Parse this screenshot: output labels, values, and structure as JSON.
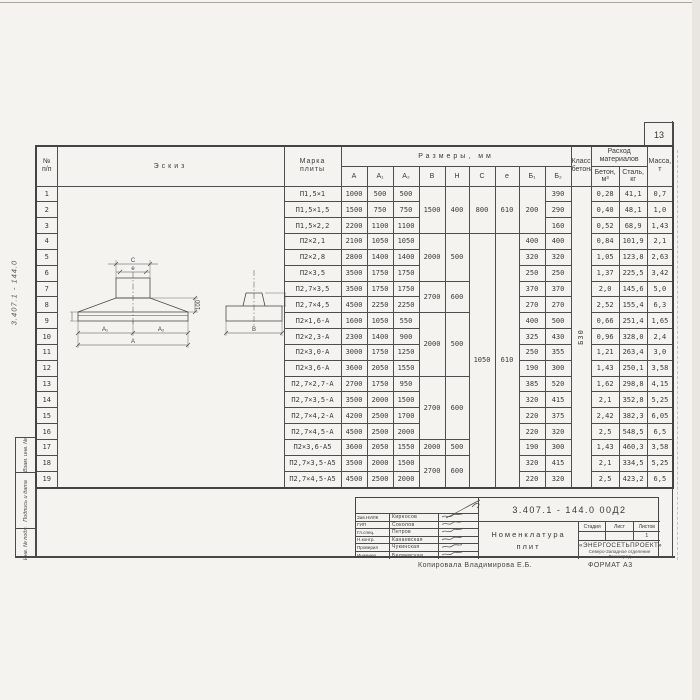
{
  "margins": {
    "page_number": "13",
    "side_ref": "3.407.1 - 144.0",
    "stamp_boxes": [
      "Взам. инв. №",
      "Подпись и дата",
      "Инв. № подл."
    ]
  },
  "table": {
    "header": {
      "num_top": "№",
      "num_bot": "п/п",
      "sketch": "Эскиз",
      "mark_top": "Марка",
      "mark_bot": "плиты",
      "dims": "Размеры, мм",
      "dim_cols": [
        "A",
        "A₁",
        "A₂",
        "B",
        "H",
        "C",
        "e",
        "Б₁",
        "Б₂"
      ],
      "class_top": "Класс",
      "class_bot": "бетона",
      "cons_top": "Расход",
      "cons_bot": "материалов",
      "cons_cols": [
        "Бетон, м³",
        "Сталь, кг"
      ],
      "mass_top": "Масса,",
      "mass_bot": "т"
    },
    "concrete_class": "Б30",
    "rows": [
      [
        "1",
        {
          "v": "",
          "rs": 19,
          "cls": "sk"
        },
        {
          "v": "П1,5×1",
          "cls": "mark"
        },
        "1000",
        "500",
        "500",
        {
          "v": "1500",
          "rs": 3
        },
        {
          "v": "400",
          "rs": 3
        },
        {
          "v": "800",
          "rs": 3
        },
        {
          "v": "610",
          "rs": 3
        },
        {
          "v": "200",
          "rs": 3
        },
        "390",
        {
          "v": "Б30",
          "rs": 19,
          "cls": "rot"
        },
        "0,28",
        "41,1",
        "0,7"
      ],
      [
        "2",
        {
          "v": "П1,5×1,5",
          "cls": "mark"
        },
        "1500",
        "750",
        "750",
        "290",
        "0,40",
        "48,1",
        "1,0"
      ],
      [
        "3",
        {
          "v": "П1,5×2,2",
          "cls": "mark"
        },
        "2200",
        "1100",
        "1100",
        "160",
        "0,52",
        "68,9",
        "1,43"
      ],
      [
        "4",
        {
          "v": "П2×2,1",
          "cls": "mark"
        },
        "2100",
        "1050",
        "1050",
        {
          "v": "2000",
          "rs": 3
        },
        {
          "v": "500",
          "rs": 3
        },
        {
          "v": "1050",
          "rs": 16
        },
        {
          "v": "610",
          "rs": 16
        },
        "400",
        "400",
        "0,84",
        "101,9",
        "2,1"
      ],
      [
        "5",
        {
          "v": "П2×2,8",
          "cls": "mark"
        },
        "2800",
        "1400",
        "1400",
        "320",
        "320",
        "1,05",
        "123,8",
        "2,63"
      ],
      [
        "6",
        {
          "v": "П2×3,5",
          "cls": "mark"
        },
        "3500",
        "1750",
        "1750",
        "250",
        "250",
        "1,37",
        "225,5",
        "3,42"
      ],
      [
        "7",
        {
          "v": "П2,7×3,5",
          "cls": "mark"
        },
        "3500",
        "1750",
        "1750",
        {
          "v": "2700",
          "rs": 2
        },
        {
          "v": "600",
          "rs": 2
        },
        "370",
        "370",
        "2,0",
        "145,6",
        "5,0"
      ],
      [
        "8",
        {
          "v": "П2,7×4,5",
          "cls": "mark"
        },
        "4500",
        "2250",
        "2250",
        "270",
        "270",
        "2,52",
        "155,4",
        "6,3"
      ],
      [
        "9",
        {
          "v": "П2×1,6-А",
          "cls": "mark"
        },
        "1600",
        "1050",
        "550",
        {
          "v": "2000",
          "rs": 4
        },
        {
          "v": "500",
          "rs": 4
        },
        "400",
        "500",
        "0,66",
        "251,4",
        "1,65"
      ],
      [
        "10",
        {
          "v": "П2×2,3-А",
          "cls": "mark"
        },
        "2300",
        "1400",
        "900",
        "325",
        "430",
        "0,96",
        "328,0",
        "2,4"
      ],
      [
        "11",
        {
          "v": "П2×3,0-А",
          "cls": "mark"
        },
        "3000",
        "1750",
        "1250",
        "250",
        "355",
        "1,21",
        "263,4",
        "3,0"
      ],
      [
        "12",
        {
          "v": "П2×3,6-А",
          "cls": "mark"
        },
        "3600",
        "2050",
        "1550",
        "190",
        "300",
        "1,43",
        "250,1",
        "3,58"
      ],
      [
        "13",
        {
          "v": "П2,7×2,7-А",
          "cls": "mark"
        },
        "2700",
        "1750",
        "950",
        {
          "v": "2700",
          "rs": 4
        },
        {
          "v": "600",
          "rs": 4
        },
        "385",
        "520",
        "1,62",
        "298,8",
        "4,15"
      ],
      [
        "14",
        {
          "v": "П2,7×3,5-А",
          "cls": "mark"
        },
        "3500",
        "2000",
        "1500",
        "320",
        "415",
        "2,1",
        "352,8",
        "5,25"
      ],
      [
        "15",
        {
          "v": "П2,7×4,2-А",
          "cls": "mark"
        },
        "4200",
        "2500",
        "1700",
        "220",
        "375",
        "2,42",
        "382,3",
        "6,05"
      ],
      [
        "16",
        {
          "v": "П2,7×4,5-А",
          "cls": "mark"
        },
        "4500",
        "2500",
        "2000",
        "220",
        "320",
        "2,5",
        "548,5",
        "6,5"
      ],
      [
        "17",
        {
          "v": "П2×3,6-А5",
          "cls": "mark"
        },
        "3600",
        "2050",
        "1550",
        {
          "v": "2000",
          "rs": 1
        },
        {
          "v": "500",
          "rs": 1
        },
        "190",
        "300",
        "1,43",
        "460,3",
        "3,58"
      ],
      [
        "18",
        {
          "v": "П2,7×3,5-А5",
          "cls": "mark"
        },
        "3500",
        "2000",
        "1500",
        {
          "v": "2700",
          "rs": 2
        },
        {
          "v": "600",
          "rs": 2
        },
        "320",
        "415",
        "2,1",
        "334,5",
        "5,25"
      ],
      [
        "19",
        {
          "v": "П2,7×4,5-А5",
          "cls": "mark"
        },
        "4500",
        "2500",
        "2000",
        "220",
        "320",
        "2,5",
        "423,2",
        "6,5"
      ]
    ]
  },
  "sketch": {
    "labels": {
      "c": "C",
      "e": "e",
      "a1": "A₁",
      "a2": "A₂",
      "a": "A",
      "b": "B",
      "dim100_left": "100",
      "dim100_right": "100"
    }
  },
  "title_block": {
    "doc_number": "3.407.1 - 144.0   00Д2",
    "title_line1": "Номенклатура",
    "title_line2": "плит",
    "stage_label": "Стадия",
    "sheet_label": "Лист",
    "sheets_label": "Листов",
    "sheets_value": "1",
    "org_name": "«ЭНЕРГОСЕТЬПРОЕКТ»",
    "org_branch": "Северо-Западное отделение",
    "org_city": "Ленинград",
    "signers": [
      {
        "role": "Зав.НИЛК",
        "name": "Кирносов"
      },
      {
        "role": "ГИП",
        "name": "Соколов"
      },
      {
        "role": "Гл.спец.",
        "name": "Петров"
      },
      {
        "role": "Н.контр.",
        "name": "Канаевская"
      },
      {
        "role": "Проверил",
        "name": "Чукинская"
      },
      {
        "role": "Инженер",
        "name": "Беляевская"
      }
    ],
    "copied": "Копировала  Владимирова Е.Б.",
    "format": "ФОРМАТ А3"
  }
}
